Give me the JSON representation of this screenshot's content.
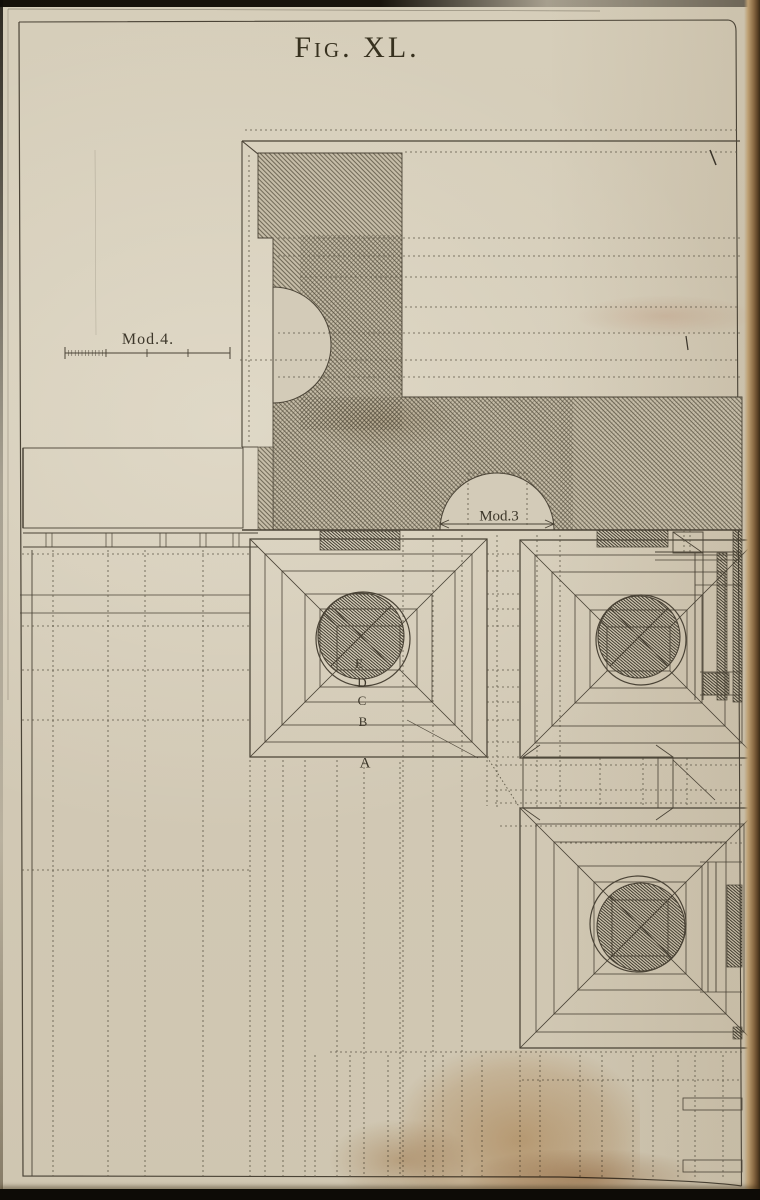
{
  "figure": {
    "title": "Fig. XL."
  },
  "labels": {
    "scale": "Mod.4.",
    "dimension": "Mod.3",
    "steps": [
      "A",
      "B",
      "C",
      "D",
      "E"
    ]
  },
  "colors": {
    "paper": "#d3cbb8",
    "ink": "#4a4336",
    "hatch_line": "#5d5645",
    "plate_border": "#4b4436",
    "page_edge": "#8a6a44",
    "stain": "#b07e3e"
  }
}
